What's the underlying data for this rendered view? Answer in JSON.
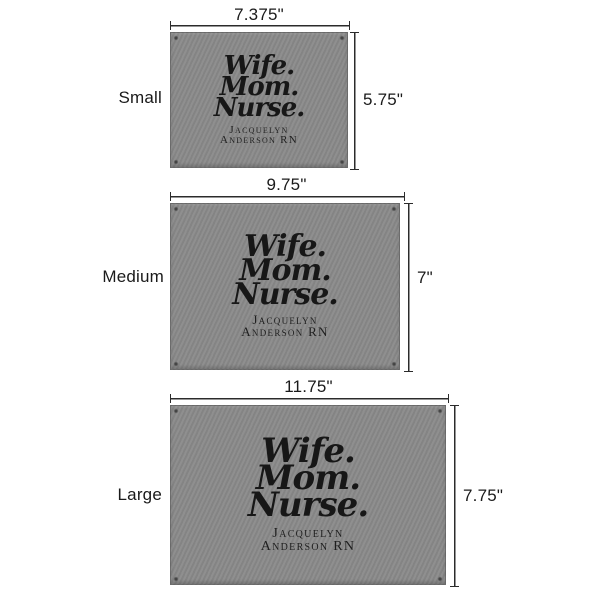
{
  "diagram": {
    "type": "product-size-comparison",
    "background": "#ffffff"
  },
  "colors": {
    "product_gray": "#8a8a8a",
    "engraving": "#171717",
    "dimension_line": "#2b2b2b",
    "label_text": "#1a1a1a"
  },
  "engraving": {
    "line1": "Wife.",
    "line2": "Mom.",
    "line3": "Nurse.",
    "name_line1": "Jacquelyn",
    "name_line2": "Anderson RN"
  },
  "sizes": [
    {
      "label": "Small",
      "width_label": "7.375\"",
      "height_label": "5.75\""
    },
    {
      "label": "Medium",
      "width_label": "9.75\"",
      "height_label": "7\""
    },
    {
      "label": "Large",
      "width_label": "11.75\"",
      "height_label": "7.75\""
    }
  ]
}
